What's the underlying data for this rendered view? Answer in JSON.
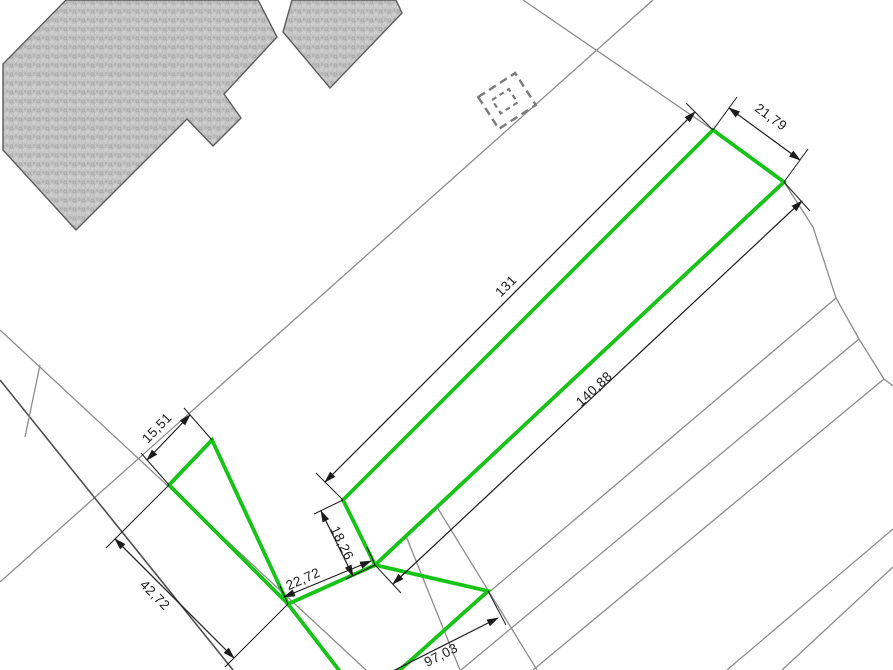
{
  "app": {
    "type": "cadastral-parcel-plan",
    "background": "#ffffff"
  },
  "colors": {
    "parcel-green": "#17c317",
    "line-gray": "#8c8c8c",
    "line-dark": "#4f4f4f",
    "dim-black": "#1c1c1c",
    "building-outline": "#5c5c5c",
    "bg": "#ffffff"
  },
  "symbols": {
    "building_hatch": "existing-building-footprint",
    "dashed_square": "planned-structure-symbol"
  },
  "labels": [
    {
      "id": "strip-top-width",
      "value": "21,79"
    },
    {
      "id": "strip-nw-side-length",
      "value": "131"
    },
    {
      "id": "strip-se-side-length",
      "value": "140,88"
    },
    {
      "id": "triangle-top-width",
      "value": "15,51"
    },
    {
      "id": "triangle-left-length",
      "value": "42,72"
    },
    {
      "id": "lower-parcel-top-width",
      "value": "22,72"
    },
    {
      "id": "strip-bottom-width",
      "value": "18,26"
    },
    {
      "id": "lower-parcel-side-length",
      "value": "97,03"
    }
  ]
}
